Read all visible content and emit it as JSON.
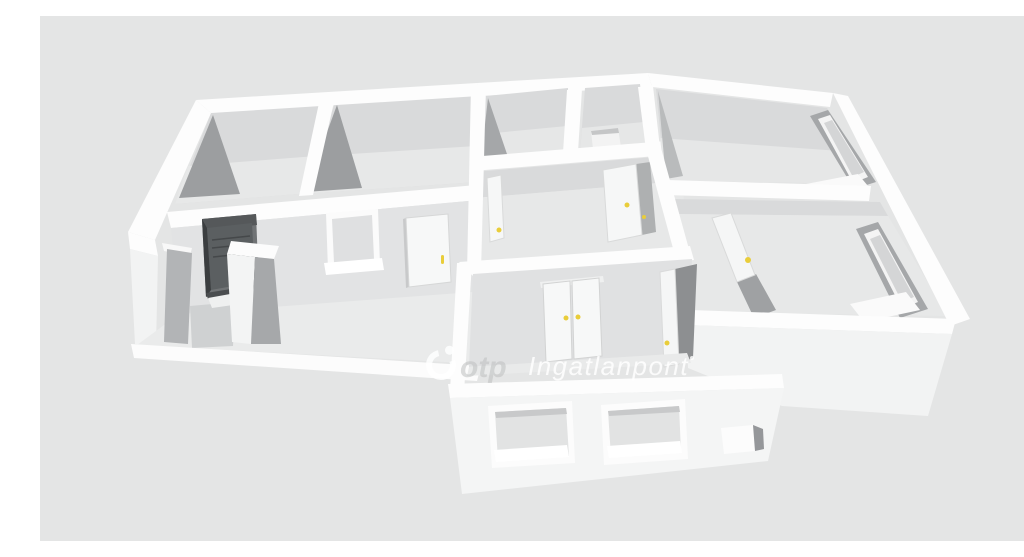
{
  "scene": {
    "type": "3d-floorplan-render",
    "description": "Isometric 3D white-wall floor plan of an apartment on a flat gray background",
    "rooms_visible": 8,
    "elements": [
      "entrance-door-dark",
      "hallway-window",
      "hallway-interior-door",
      "middle-room-left-door",
      "middle-room-right-door",
      "right-room-door",
      "double-door-lower-room",
      "lower-room-open-door",
      "front-window-1",
      "front-window-2",
      "front-window-small",
      "right-wall-window-upper",
      "right-wall-window-lower"
    ]
  },
  "watermark": {
    "brand": "otp",
    "name": "Ingatlanpont"
  },
  "colors": {
    "background": "#e4e5e5",
    "wall_top": "#fdfdfd",
    "wall_face_interior": "#d9dadb",
    "floor": "#e7e8e8",
    "shadow": "#9c9ea0",
    "exterior_face": "#f3f4f4",
    "entrance_door": "#5b5f61",
    "entrance_door_frame": "#707375",
    "handle_yellow": "#e9cd3a",
    "watermark_white": "rgba(255,255,255,0.85)",
    "watermark_gray": "rgba(190,191,192,0.55)"
  }
}
